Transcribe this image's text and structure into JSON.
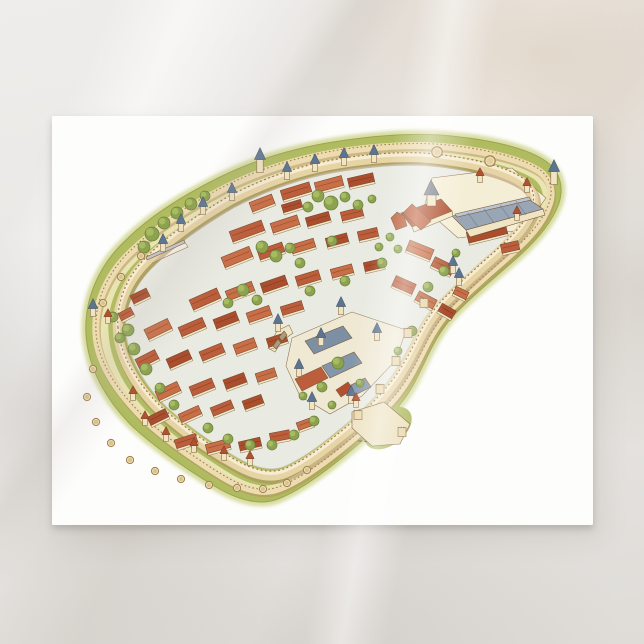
{
  "scene": {
    "subject": "Aerial watercolor illustration of a medieval walled city on a postcard",
    "surface": "marble"
  },
  "colors": {
    "marble_base": "#e8e6e3",
    "card": "#fdfdfc",
    "grass": "#aeba5c",
    "grass_halo": "#c6cc74",
    "lists_path": "#efe9bd",
    "wall_light": "#eddcb0",
    "wall_mid": "#e7d4a4",
    "wall_shadow": "#b4935f",
    "street": "#e9eae2",
    "facade": "#f2e8c9",
    "outline": "#8a6f48",
    "cone_blue": "#5d7490",
    "cone_red": "#b0512f",
    "roof_slate": "#98a6b5",
    "tree": "#8ca24f"
  },
  "illustration": {
    "roof_palette": [
      "#bc5e3b",
      "#c96f47",
      "#ab4e2e",
      "#cf8156"
    ],
    "ground": [
      {
        "n": "hall-courtyard",
        "p": "424,208 432,178 512,168 546,198 522,230 458,238",
        "c": "#f5eed6"
      },
      {
        "n": "castle-courtyard",
        "p": "292,338 352,312 406,330 396,360 362,396 330,414 300,396 286,366",
        "c": "#efe9d4"
      },
      {
        "n": "entry-ramp",
        "p": "146,258 184,241 188,247 150,264",
        "c": "#f5f1e3"
      },
      {
        "n": "bridge",
        "p": "268,348 277,331 289,325 293,333 282,341 275,352",
        "c": "#f0e7c7"
      }
    ],
    "landmarks": [
      {
        "n": "barbican-court",
        "p": "352,412 384,402 410,424 400,444 372,446 352,428",
        "c": "#ece0bc"
      },
      {
        "n": "ramp-roof",
        "p": "146,257 184,240 185,243 147,260",
        "c": "#c2c5c9"
      },
      {
        "n": "hall-facade",
        "p": "466,230 543,209 545,215 470,237",
        "c": "#efe4c4"
      },
      {
        "n": "hall-roof",
        "p": "452,216 527,198 543,209 466,230",
        "c": "#98a6b5"
      },
      {
        "n": "hall-ridge",
        "p": "455,214 529,197 531,200 457,217",
        "c": "#bac5d2"
      },
      {
        "n": "cathedral-facade",
        "p": "412,227 452,211 453,216 414,232",
        "c": "#f2e8c9"
      },
      {
        "n": "cathedral-nave",
        "p": "401,213 441,199 452,211 412,227",
        "c": "#b2502f"
      },
      {
        "n": "cathedral-transept",
        "p": "412,204 431,221 421,230 403,213",
        "c": "#c0613c"
      },
      {
        "n": "cathedral-apse",
        "p": "391,218 396,230 407,226 404,216 397,212",
        "c": "#bd5f3c"
      },
      {
        "n": "cathedral-tower",
        "p": "427,194 436,194 436,206 427,206",
        "c": "#f2e8c9"
      },
      {
        "n": "cathedral-spire",
        "p": "424,195 439,195 431,180",
        "c": "#7b8494"
      },
      {
        "n": "castle-hall-a",
        "p": "305,341 343,326 352,338 314,354",
        "c": "#7d8fa3"
      },
      {
        "n": "castle-hall-b",
        "p": "322,366 354,352 362,363 330,378",
        "c": "#8496a9"
      },
      {
        "n": "castle-hall-c",
        "p": "295,379 321,367 328,378 302,391",
        "c": "#bc5e3b"
      },
      {
        "n": "castle-hall-d",
        "p": "345,388 365,378 371,387 351,397",
        "c": "#8496a9"
      },
      {
        "n": "castle-stair",
        "p": "336,390 348,382 353,389 341,397",
        "c": "#b2502f"
      },
      {
        "n": "bridge-arch",
        "p": "273,346 278,339 281,343 276,349",
        "c": "#a89d80"
      },
      {
        "n": "bridge-arch",
        "p": "279,337 284,331 287,335 282,341",
        "c": "#a89d80"
      }
    ],
    "buildings": [
      [
        296,
        191,
        30,
        10,
        -17,
        0
      ],
      [
        329,
        184,
        28,
        10,
        -15,
        1
      ],
      [
        361,
        180,
        26,
        9,
        -13,
        2
      ],
      [
        262,
        203,
        24,
        10,
        -21,
        1
      ],
      [
        292,
        206,
        20,
        8,
        -17,
        2
      ],
      [
        247,
        231,
        34,
        11,
        -20,
        0
      ],
      [
        285,
        224,
        28,
        10,
        -18,
        1
      ],
      [
        318,
        219,
        24,
        9,
        -16,
        2
      ],
      [
        352,
        214,
        22,
        9,
        -14,
        0
      ],
      [
        237,
        257,
        30,
        11,
        -22,
        1
      ],
      [
        271,
        251,
        26,
        10,
        -19,
        0
      ],
      [
        303,
        246,
        24,
        9,
        -17,
        1
      ],
      [
        337,
        240,
        22,
        9,
        -15,
        2
      ],
      [
        368,
        234,
        20,
        9,
        -13,
        0
      ],
      [
        420,
        250,
        26,
        11,
        22,
        1
      ],
      [
        443,
        266,
        22,
        10,
        26,
        0
      ],
      [
        205,
        299,
        30,
        11,
        -24,
        0
      ],
      [
        240,
        291,
        28,
        10,
        -21,
        1
      ],
      [
        274,
        284,
        26,
        10,
        -19,
        2
      ],
      [
        308,
        278,
        24,
        10,
        -17,
        0
      ],
      [
        342,
        271,
        22,
        9,
        -15,
        1
      ],
      [
        374,
        265,
        20,
        9,
        -13,
        2
      ],
      [
        404,
        285,
        22,
        11,
        24,
        0
      ],
      [
        426,
        300,
        20,
        10,
        28,
        1
      ],
      [
        158,
        329,
        26,
        11,
        -26,
        1
      ],
      [
        192,
        327,
        26,
        10,
        -23,
        0
      ],
      [
        226,
        320,
        24,
        10,
        -21,
        2
      ],
      [
        259,
        314,
        24,
        10,
        -19,
        1
      ],
      [
        292,
        308,
        22,
        9,
        -17,
        0
      ],
      [
        147,
        359,
        22,
        10,
        -27,
        0
      ],
      [
        179,
        359,
        24,
        10,
        -24,
        2
      ],
      [
        212,
        352,
        24,
        10,
        -22,
        0
      ],
      [
        245,
        346,
        22,
        10,
        -20,
        1
      ],
      [
        277,
        340,
        20,
        9,
        -18,
        2
      ],
      [
        168,
        391,
        24,
        10,
        -25,
        1
      ],
      [
        202,
        387,
        24,
        10,
        -22,
        0
      ],
      [
        235,
        381,
        22,
        10,
        -20,
        2
      ],
      [
        266,
        375,
        20,
        9,
        -18,
        1
      ],
      [
        158,
        417,
        20,
        9,
        -26,
        2
      ],
      [
        190,
        414,
        22,
        9,
        -24,
        1
      ],
      [
        222,
        408,
        22,
        9,
        -22,
        0
      ],
      [
        253,
        402,
        20,
        9,
        -20,
        2
      ],
      [
        186,
        441,
        22,
        9,
        -18,
        0
      ],
      [
        218,
        446,
        24,
        9,
        -15,
        1
      ],
      [
        250,
        444,
        22,
        9,
        -13,
        2
      ],
      [
        280,
        436,
        20,
        9,
        -11,
        0
      ],
      [
        305,
        424,
        16,
        8,
        -20,
        1
      ],
      [
        140,
        296,
        18,
        9,
        -26,
        2
      ],
      [
        126,
        314,
        14,
        8,
        -28,
        0
      ],
      [
        487,
        233,
        40,
        11,
        -14,
        2
      ],
      [
        510,
        247,
        18,
        9,
        -13,
        0
      ],
      [
        447,
        311,
        16,
        9,
        30,
        2
      ],
      [
        461,
        293,
        14,
        8,
        26,
        1
      ]
    ],
    "trees": [
      [
        152,
        234,
        7
      ],
      [
        164,
        223,
        6
      ],
      [
        177,
        213,
        6
      ],
      [
        191,
        204,
        6
      ],
      [
        144,
        247,
        6
      ],
      [
        205,
        196,
        5
      ],
      [
        318,
        196,
        6
      ],
      [
        331,
        203,
        7
      ],
      [
        345,
        197,
        5
      ],
      [
        308,
        207,
        5
      ],
      [
        358,
        205,
        5
      ],
      [
        372,
        199,
        4
      ],
      [
        262,
        247,
        6
      ],
      [
        276,
        256,
        6
      ],
      [
        290,
        248,
        5
      ],
      [
        332,
        241,
        5
      ],
      [
        300,
        263,
        5
      ],
      [
        243,
        290,
        6
      ],
      [
        257,
        300,
        5
      ],
      [
        228,
        303,
        5
      ],
      [
        310,
        291,
        5
      ],
      [
        345,
        281,
        5
      ],
      [
        382,
        263,
        5
      ],
      [
        398,
        249,
        4
      ],
      [
        428,
        287,
        5
      ],
      [
        444,
        271,
        5
      ],
      [
        456,
        253,
        4
      ],
      [
        128,
        330,
        6
      ],
      [
        134,
        349,
        6
      ],
      [
        146,
        369,
        6
      ],
      [
        160,
        388,
        5
      ],
      [
        174,
        405,
        5
      ],
      [
        338,
        363,
        6
      ],
      [
        322,
        387,
        5
      ],
      [
        303,
        396,
        4
      ],
      [
        360,
        383,
        4
      ],
      [
        208,
        428,
        5
      ],
      [
        228,
        439,
        5
      ],
      [
        250,
        445,
        5
      ],
      [
        272,
        445,
        5
      ],
      [
        294,
        435,
        5
      ],
      [
        314,
        421,
        5
      ],
      [
        332,
        405,
        4
      ],
      [
        412,
        331,
        5
      ],
      [
        398,
        351,
        4
      ],
      [
        390,
        237,
        4
      ],
      [
        379,
        247,
        4
      ],
      [
        113,
        317,
        5
      ],
      [
        120,
        338,
        5
      ]
    ],
    "towers": {
      "blue": [
        [
          203,
          214
        ],
        [
          232,
          200
        ],
        [
          287,
          179
        ],
        [
          315,
          171
        ],
        [
          344,
          165
        ],
        [
          374,
          162
        ],
        [
          181,
          231
        ],
        [
          163,
          251
        ],
        [
          93,
          316
        ],
        [
          453,
          273
        ],
        [
          459,
          285
        ],
        [
          341,
          314
        ],
        [
          377,
          340
        ],
        [
          321,
          345
        ],
        [
          299,
          376
        ],
        [
          351,
          403
        ],
        [
          312,
          409
        ],
        [
          278,
          331
        ]
      ],
      "blue_tall": [
        [
          260,
          172
        ],
        [
          554,
          184
        ]
      ],
      "red": [
        [
          480,
          182
        ],
        [
          527,
          192
        ],
        [
          517,
          220
        ],
        [
          133,
          400
        ],
        [
          145,
          425
        ],
        [
          166,
          441
        ],
        [
          194,
          452
        ],
        [
          224,
          460
        ],
        [
          250,
          465
        ],
        [
          108,
          323
        ],
        [
          356,
          407
        ]
      ],
      "open": [
        [
          93,
          369
        ],
        [
          87,
          397
        ],
        [
          96,
          422
        ],
        [
          111,
          443
        ],
        [
          130,
          460
        ],
        [
          155,
          471
        ],
        [
          181,
          479
        ],
        [
          209,
          485
        ],
        [
          237,
          488
        ],
        [
          263,
          489
        ],
        [
          287,
          483
        ],
        [
          307,
          470
        ],
        [
          103,
          303
        ],
        [
          121,
          277
        ],
        [
          141,
          256
        ]
      ],
      "open_large": [
        [
          437,
          152
        ],
        [
          490,
          161
        ]
      ],
      "square": [
        [
          424,
          303
        ],
        [
          408,
          333
        ],
        [
          396,
          361
        ],
        [
          380,
          389
        ],
        [
          358,
          415
        ],
        [
          402,
          432
        ]
      ]
    }
  }
}
